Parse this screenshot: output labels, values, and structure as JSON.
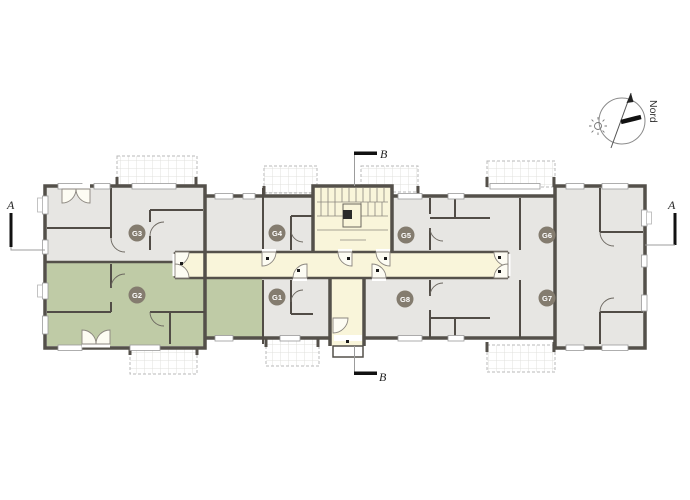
{
  "compass": {
    "label": "Nord"
  },
  "section_markers": {
    "left_label": "A",
    "right_label": "A",
    "top_label": "B",
    "bottom_label": "B"
  },
  "apartments": [
    {
      "id": "G1",
      "label": "G1",
      "highlighted": false
    },
    {
      "id": "G2",
      "label": "G2",
      "highlighted": true
    },
    {
      "id": "G3",
      "label": "G3",
      "highlighted": false
    },
    {
      "id": "G4",
      "label": "G4",
      "highlighted": false
    },
    {
      "id": "G5",
      "label": "G5",
      "highlighted": false
    },
    {
      "id": "G6",
      "label": "G6",
      "highlighted": false
    },
    {
      "id": "G7",
      "label": "G7",
      "highlighted": false
    },
    {
      "id": "G8",
      "label": "G8",
      "highlighted": false
    }
  ],
  "colors": {
    "wall": "#54504a",
    "apartment_floor": "#e7e6e3",
    "highlighted_apartment": "#bfcba6",
    "circulation": "#f9f5da",
    "badge": "#847c6f",
    "balcony_outline": "#b9b9b9",
    "background": "#ffffff"
  }
}
